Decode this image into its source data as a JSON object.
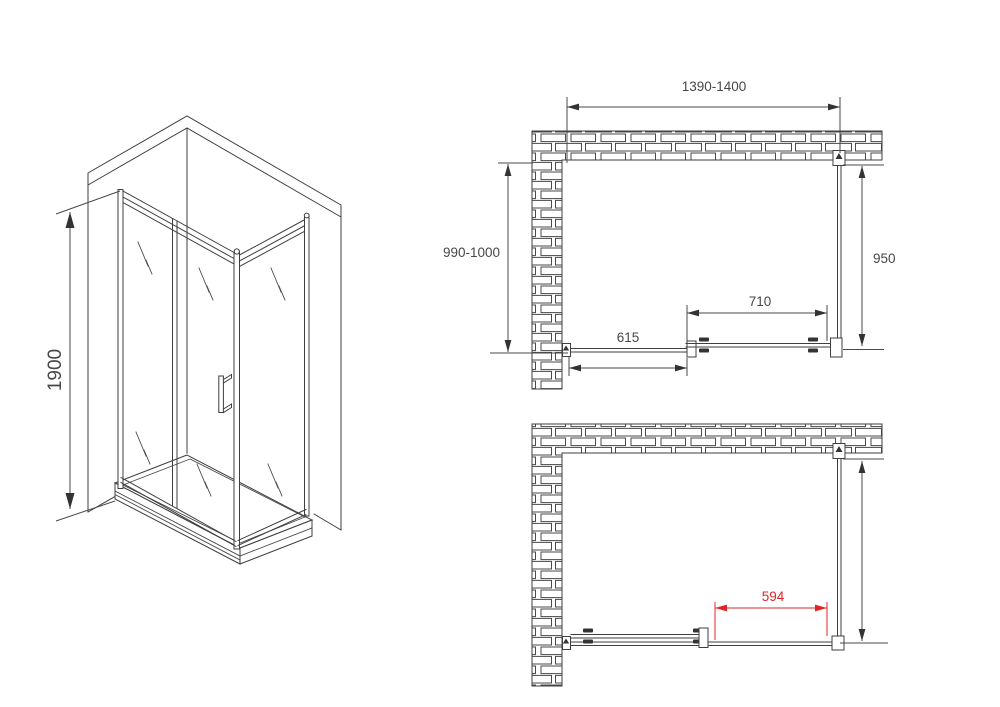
{
  "colors": {
    "background": "#ffffff",
    "line": "#3f3f3f",
    "dimension_text": "#474747",
    "accent_red": "#e02428"
  },
  "isometric_view": {
    "height_dimension": "1900"
  },
  "plan_view_closed": {
    "overall_width_dimension": "1390-1400",
    "depth_dimension": "990-1000",
    "side_panel_dimension": "950",
    "sliding_door_dimension": "710",
    "fixed_panel_dimension": "615"
  },
  "plan_view_open": {
    "opening_width_dimension": "594"
  }
}
